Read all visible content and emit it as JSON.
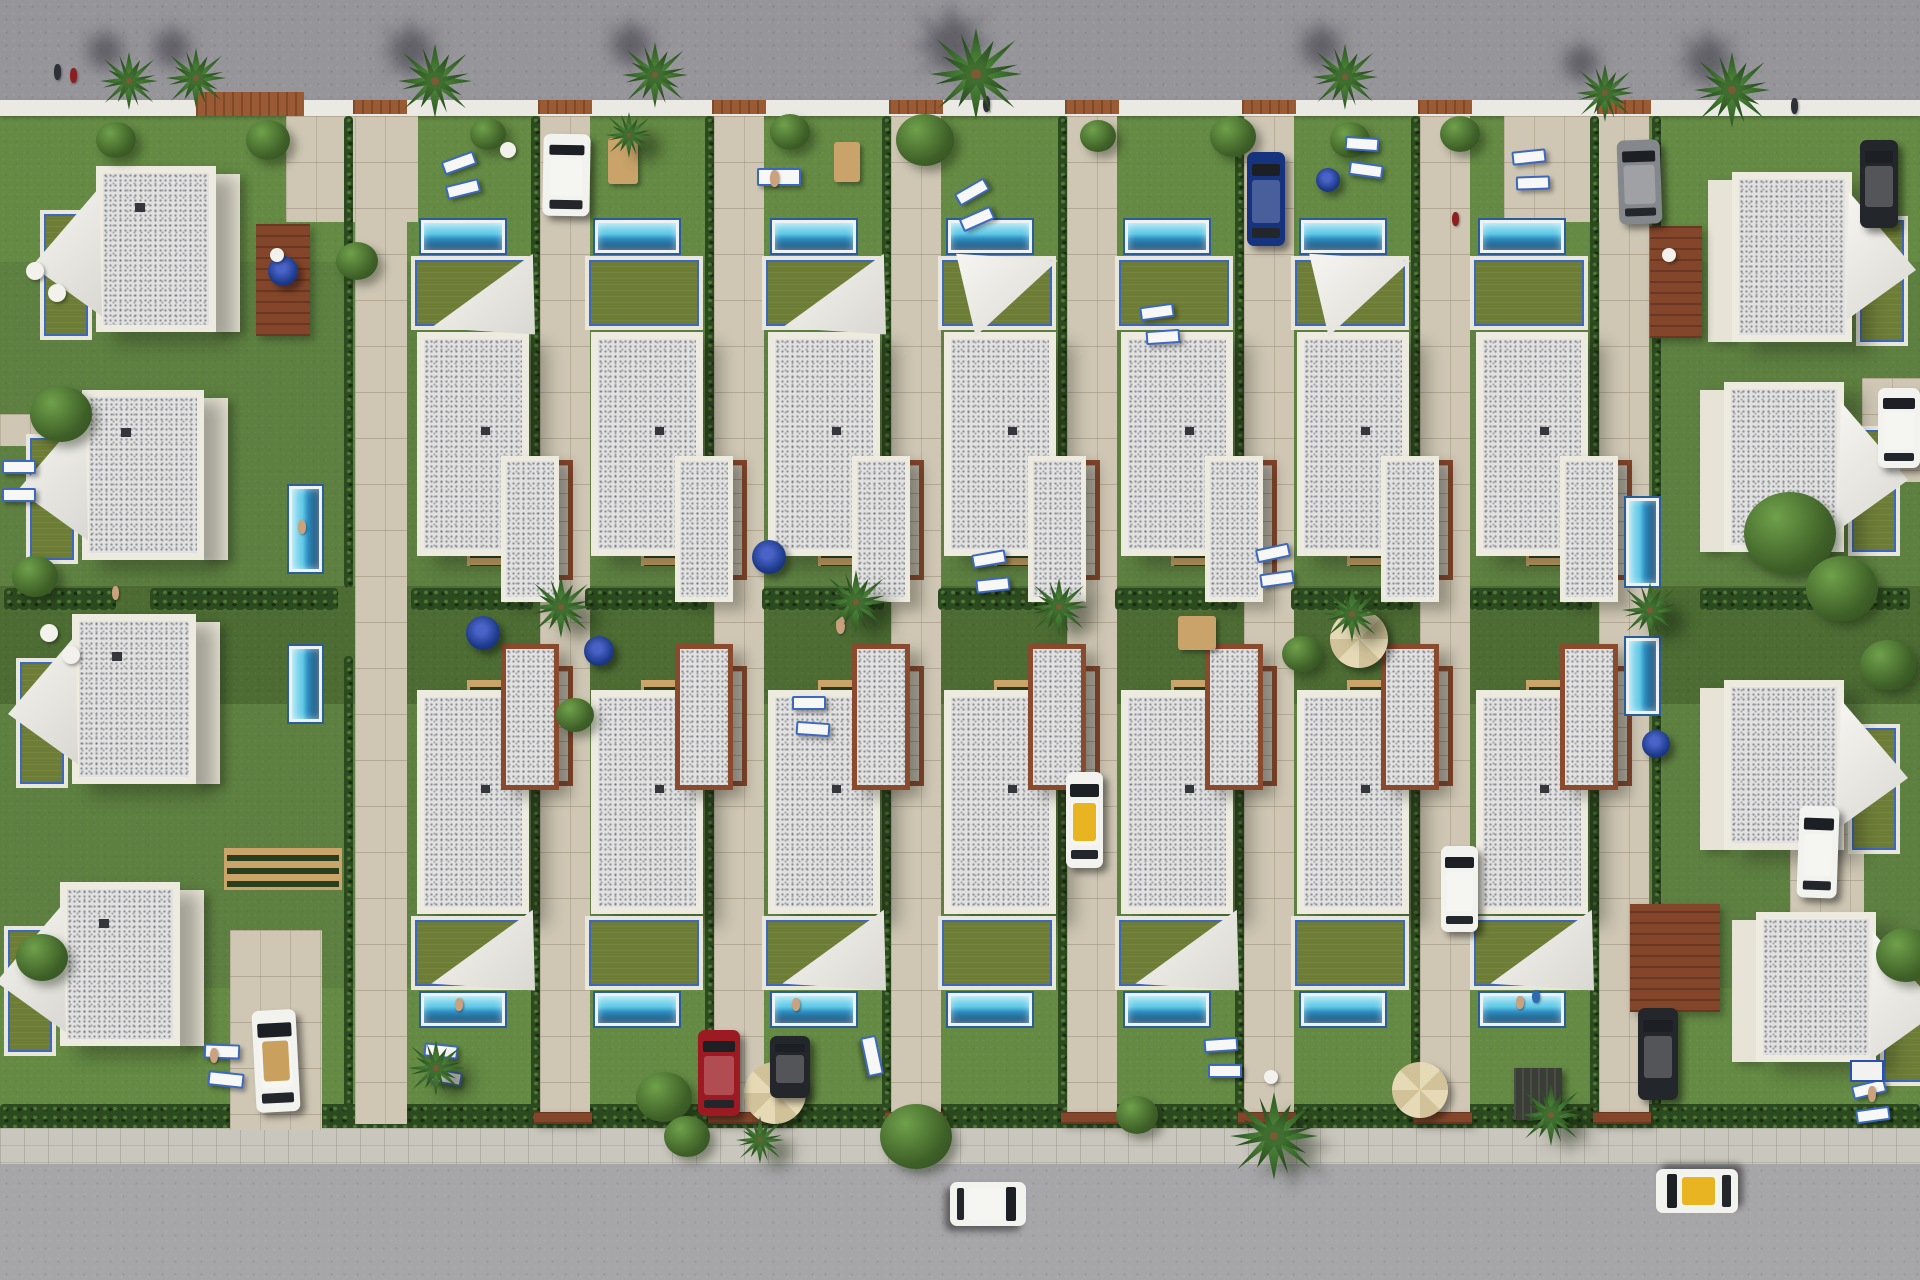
{
  "meta": {
    "description": "Aerial top-down 3D render of a seaside villa development: two rows of white flat-roof villas with private pools and gardens between two gray roads",
    "width": 1920,
    "height": 1280
  },
  "palette": {
    "road_top": "#96959a",
    "road_bottom": "#a6a5a8",
    "curb_white": "#eae9e3",
    "curb_cobble": "#c9c6bd",
    "lawn": "#5d8041",
    "lawn_light": "#648a44",
    "lawn_dark": "#4c6c33",
    "hedge": "#2c4a1f",
    "pavement": "#cfc7b4",
    "roof_speckle": "#e1e1e1",
    "parapet": "#edebe0",
    "wall_cream": "#e7e3d6",
    "terrace_turf": "#6d7d36",
    "balustrade_blue": "#3c68c0",
    "pool_light": "#a8e4f4",
    "pool_deep": "#16436b",
    "pool_trim": "#2a5d9c",
    "wood_deck": "#84462b",
    "wood_stairs": "#caa468",
    "sail_white": "#f7f6f2",
    "umbrella_navy": "#1e3c8c",
    "umbrella_beige": "#e6d9b5",
    "car_red": "#9c1a22",
    "car_blue": "#16337f",
    "car_gray": "#84878b",
    "car_dark": "#23262b",
    "taxi_yellow": "#e8b421"
  },
  "bands": [
    {
      "cls": "lawn",
      "r": [
        0,
        114,
        1920,
        1012
      ],
      "name": "site-lawn"
    },
    {
      "cls": "lawnL",
      "r": [
        0,
        114,
        1920,
        148
      ],
      "name": "front-gardens-top"
    },
    {
      "cls": "lawnL",
      "r": [
        0,
        988,
        1920,
        142
      ],
      "name": "front-gardens-bottom"
    },
    {
      "cls": "lawnD",
      "r": [
        0,
        586,
        1920,
        118
      ],
      "name": "central-common-lawn"
    },
    {
      "cls": "road",
      "r": [
        0,
        0,
        1920,
        102
      ],
      "name": "top-road"
    },
    {
      "cls": "curb",
      "r": [
        0,
        100,
        1920,
        16
      ],
      "name": "top-perimeter-wall"
    },
    {
      "cls": "hedge",
      "r": [
        0,
        1104,
        1920,
        26
      ],
      "name": "bottom-perimeter-hedge"
    },
    {
      "cls": "curb-b",
      "r": [
        0,
        1128,
        1920,
        38
      ],
      "name": "bottom-sidewalk"
    },
    {
      "cls": "road-b",
      "r": [
        0,
        1164,
        1920,
        116
      ],
      "name": "bottom-road"
    }
  ],
  "units": {
    "xs": [
      409,
      583,
      760,
      936,
      1113,
      1289,
      1468
    ],
    "mirror_axis": 1246,
    "top": {
      "pool": [
        12,
        220,
        84,
        33
      ],
      "terrace": [
        2,
        256,
        118,
        74
      ],
      "roof": [
        8,
        332,
        112,
        224
      ],
      "wing": [
        92,
        456,
        58,
        146
      ],
      "slab": [
        118,
        460,
        46,
        120
      ],
      "stairs": [
        58,
        480,
        50,
        86
      ]
    },
    "top_sails": [
      0,
      2,
      3,
      5
    ],
    "bottom_sails": [
      0,
      2,
      4,
      6
    ],
    "driveway_offset": 131,
    "driveway_width": 50,
    "driveway_y": 116,
    "driveway_h": 1008
  },
  "extra_paves": [
    [
      286,
      116,
      132,
      106
    ],
    [
      1504,
      116,
      136,
      106
    ],
    [
      230,
      930,
      92,
      200
    ],
    [
      355,
      116,
      52,
      1008
    ],
    [
      1790,
      788,
      74,
      124
    ],
    [
      1862,
      378,
      58,
      104
    ],
    [
      0,
      414,
      58,
      32
    ],
    [
      1862,
      414,
      58,
      32
    ]
  ],
  "extra_hedges_v": [
    [
      344,
      116,
      9,
      472
    ],
    [
      344,
      656,
      9,
      452
    ],
    [
      1652,
      116,
      9,
      472
    ],
    [
      1652,
      656,
      9,
      452
    ]
  ],
  "hedgerow_extra": [
    [
      4,
      588,
      112,
      22
    ],
    [
      150,
      588,
      188,
      22
    ],
    [
      1700,
      588,
      210,
      22
    ]
  ],
  "corner_villas": {
    "left": [
      [
        96,
        166,
        120,
        166
      ],
      [
        82,
        390,
        122,
        170
      ],
      [
        72,
        614,
        124,
        170
      ],
      [
        60,
        882,
        120,
        164
      ]
    ],
    "right": [
      [
        1732,
        172,
        120,
        170
      ],
      [
        1724,
        382,
        120,
        170
      ],
      [
        1724,
        680,
        120,
        170
      ],
      [
        1756,
        912,
        120,
        150
      ]
    ]
  },
  "vertical_pools": [
    [
      289,
      486,
      33,
      86
    ],
    [
      289,
      646,
      33,
      76
    ],
    [
      1626,
      498,
      33,
      88
    ],
    [
      1626,
      638,
      33,
      76
    ]
  ],
  "decks": [
    {
      "cls": "deck",
      "r": [
        256,
        224,
        54,
        112
      ]
    },
    {
      "cls": "deck",
      "r": [
        1650,
        226,
        52,
        112
      ]
    },
    {
      "cls": "deck",
      "r": [
        1630,
        904,
        90,
        108
      ]
    },
    {
      "cls": "stairs",
      "r": [
        224,
        848,
        118,
        42
      ]
    },
    {
      "cls": "deck-top",
      "r": [
        196,
        92,
        108,
        24
      ]
    }
  ],
  "palms": [
    [
      100,
      52,
      58,
      "ul"
    ],
    [
      166,
      48,
      60,
      "ul"
    ],
    [
      398,
      44,
      74,
      "ul"
    ],
    [
      622,
      42,
      66,
      "ul"
    ],
    [
      930,
      28,
      92,
      "ul"
    ],
    [
      1312,
      44,
      66,
      "ul"
    ],
    [
      1576,
      64,
      58,
      "ul"
    ],
    [
      1694,
      52,
      76,
      "ul"
    ],
    [
      606,
      112,
      46,
      "dr"
    ],
    [
      530,
      576,
      62,
      "dr"
    ],
    [
      824,
      570,
      64,
      "dr"
    ],
    [
      1030,
      578,
      58,
      "dr"
    ],
    [
      1324,
      586,
      56,
      "dr"
    ],
    [
      1622,
      582,
      56,
      "dr"
    ],
    [
      408,
      1040,
      56,
      "dr"
    ],
    [
      1230,
      1092,
      88,
      "dr"
    ],
    [
      1520,
      1084,
      62,
      "dr"
    ],
    [
      736,
      1116,
      48,
      "dr"
    ]
  ],
  "bushes": [
    [
      96,
      122,
      40
    ],
    [
      246,
      120,
      44
    ],
    [
      470,
      118,
      36
    ],
    [
      770,
      114,
      40
    ],
    [
      896,
      114,
      58
    ],
    [
      1080,
      120,
      36
    ],
    [
      1210,
      116,
      46
    ],
    [
      1330,
      122,
      40
    ],
    [
      1440,
      116,
      40
    ],
    [
      30,
      386,
      62
    ],
    [
      12,
      556,
      46
    ],
    [
      336,
      242,
      42
    ],
    [
      1744,
      492,
      92
    ],
    [
      1806,
      556,
      72
    ],
    [
      1860,
      640,
      56
    ],
    [
      556,
      698,
      38
    ],
    [
      1282,
      636,
      40
    ],
    [
      636,
      1072,
      56
    ],
    [
      880,
      1104,
      72
    ],
    [
      664,
      1116,
      46
    ],
    [
      1116,
      1096,
      42
    ],
    [
      16,
      934,
      52
    ],
    [
      1876,
      928,
      60
    ]
  ],
  "cars": [
    {
      "v": "white",
      "x": 543,
      "y": 134,
      "w": 47,
      "h": 82,
      "r": 1
    },
    {
      "v": "blue",
      "x": 1247,
      "y": 152,
      "w": 38,
      "h": 94,
      "r": 0
    },
    {
      "v": "gray",
      "x": 1618,
      "y": 140,
      "w": 43,
      "h": 84,
      "r": -2
    },
    {
      "v": "dark",
      "x": 1860,
      "y": 140,
      "w": 38,
      "h": 88,
      "r": 0
    },
    {
      "v": "white",
      "x": 1878,
      "y": 388,
      "w": 42,
      "h": 80,
      "r": 0
    },
    {
      "v": "taxi",
      "x": 1066,
      "y": 772,
      "w": 37,
      "h": 96,
      "r": 0
    },
    {
      "v": "white",
      "x": 1441,
      "y": 846,
      "w": 37,
      "h": 86,
      "r": 0
    },
    {
      "v": "white",
      "x": 1798,
      "y": 806,
      "w": 40,
      "h": 92,
      "r": 2
    },
    {
      "v": "conv",
      "x": 254,
      "y": 1010,
      "w": 44,
      "h": 102,
      "r": -3
    },
    {
      "v": "red",
      "x": 698,
      "y": 1030,
      "w": 42,
      "h": 86,
      "r": 0
    },
    {
      "v": "dark",
      "x": 770,
      "y": 1036,
      "w": 40,
      "h": 62,
      "r": 0
    },
    {
      "v": "dark",
      "x": 1638,
      "y": 1008,
      "w": 40,
      "h": 92,
      "r": 0
    },
    {
      "v": "white",
      "x": 966,
      "y": 1166,
      "w": 44,
      "h": 76,
      "r": 90
    },
    {
      "v": "taxi",
      "x": 1675,
      "y": 1150,
      "w": 44,
      "h": 82,
      "r": -90
    }
  ],
  "props": [
    {
      "t": "umb-n",
      "r": [
        752,
        540,
        34,
        34
      ]
    },
    {
      "t": "umb-n",
      "r": [
        466,
        616,
        34,
        34
      ]
    },
    {
      "t": "umb-n",
      "r": [
        584,
        636,
        30,
        30
      ]
    },
    {
      "t": "umb-n",
      "r": [
        1316,
        168,
        24,
        24
      ]
    },
    {
      "t": "umb-n",
      "r": [
        1536,
        1096,
        22,
        22
      ]
    },
    {
      "t": "umb-n",
      "r": [
        1642,
        730,
        28,
        28
      ]
    },
    {
      "t": "umb-n",
      "r": [
        268,
        256,
        30,
        30
      ]
    },
    {
      "t": "umb-b",
      "r": [
        744,
        1062,
        62,
        62
      ]
    },
    {
      "t": "umb-b",
      "r": [
        1392,
        1062,
        56,
        56
      ]
    },
    {
      "t": "umb-b",
      "r": [
        1330,
        610,
        58,
        58
      ]
    },
    {
      "t": "table",
      "r": [
        608,
        138,
        30,
        46
      ]
    },
    {
      "t": "table",
      "r": [
        834,
        142,
        26,
        40
      ]
    },
    {
      "t": "table",
      "r": [
        1178,
        616,
        38,
        34
      ]
    },
    {
      "t": "lounger",
      "r": [
        442,
        156,
        34,
        14
      ],
      "rot": -20
    },
    {
      "t": "lounger",
      "r": [
        446,
        182,
        34,
        14
      ],
      "rot": -14
    },
    {
      "t": "lounger",
      "r": [
        955,
        185,
        34,
        14
      ],
      "rot": -30
    },
    {
      "t": "lounger",
      "r": [
        960,
        212,
        34,
        14
      ],
      "rot": -24
    },
    {
      "t": "lounger",
      "r": [
        1512,
        150,
        34,
        14
      ],
      "rot": -6
    },
    {
      "t": "lounger",
      "r": [
        1516,
        176,
        34,
        14
      ],
      "rot": -2
    },
    {
      "t": "lounger",
      "r": [
        1345,
        137,
        34,
        14
      ],
      "rot": 4
    },
    {
      "t": "lounger",
      "r": [
        1349,
        163,
        34,
        14
      ],
      "rot": 8
    },
    {
      "t": "lounger",
      "r": [
        757,
        168,
        44,
        18
      ],
      "rot": 0
    },
    {
      "t": "lounger",
      "r": [
        1140,
        305,
        34,
        14
      ],
      "rot": -8
    },
    {
      "t": "lounger",
      "r": [
        1146,
        330,
        34,
        14
      ],
      "rot": -4
    },
    {
      "t": "lounger",
      "r": [
        2,
        460,
        34,
        14
      ],
      "rot": 0
    },
    {
      "t": "lounger",
      "r": [
        2,
        488,
        34,
        14
      ],
      "rot": 0
    },
    {
      "t": "lounger",
      "r": [
        972,
        552,
        34,
        14
      ],
      "rot": -10
    },
    {
      "t": "lounger",
      "r": [
        976,
        578,
        34,
        14
      ],
      "rot": -6
    },
    {
      "t": "lounger",
      "r": [
        1256,
        546,
        34,
        14
      ],
      "rot": -12
    },
    {
      "t": "lounger",
      "r": [
        1260,
        572,
        34,
        14
      ],
      "rot": -8
    },
    {
      "t": "lounger",
      "r": [
        792,
        696,
        34,
        14
      ],
      "rot": 0
    },
    {
      "t": "lounger",
      "r": [
        796,
        722,
        34,
        14
      ],
      "rot": 4
    },
    {
      "t": "lounger",
      "r": [
        424,
        1044,
        34,
        14
      ],
      "rot": 6
    },
    {
      "t": "lounger",
      "r": [
        428,
        1070,
        34,
        14
      ],
      "rot": 10
    },
    {
      "t": "lounger",
      "r": [
        852,
        1048,
        40,
        16
      ],
      "rot": 78
    },
    {
      "t": "lounger",
      "r": [
        1204,
        1038,
        34,
        14
      ],
      "rot": -4
    },
    {
      "t": "lounger",
      "r": [
        1208,
        1064,
        34,
        14
      ],
      "rot": 0
    },
    {
      "t": "lounger",
      "r": [
        1852,
        1082,
        34,
        14
      ],
      "rot": -14
    },
    {
      "t": "lounger",
      "r": [
        1856,
        1108,
        34,
        14
      ],
      "rot": -8
    },
    {
      "t": "lounger",
      "r": [
        204,
        1044,
        36,
        15
      ],
      "rot": 2
    },
    {
      "t": "lounger",
      "r": [
        208,
        1072,
        36,
        15
      ],
      "rot": 6
    },
    {
      "t": "chair",
      "r": [
        500,
        142,
        16,
        16
      ]
    },
    {
      "t": "chair",
      "r": [
        26,
        262,
        18,
        18
      ]
    },
    {
      "t": "chair",
      "r": [
        48,
        284,
        18,
        18
      ]
    },
    {
      "t": "chair",
      "r": [
        270,
        248,
        14,
        14
      ]
    },
    {
      "t": "chair",
      "r": [
        1662,
        248,
        14,
        14
      ]
    },
    {
      "t": "chair",
      "r": [
        40,
        624,
        18,
        18
      ]
    },
    {
      "t": "chair",
      "r": [
        62,
        646,
        18,
        18
      ]
    },
    {
      "t": "chair",
      "r": [
        1264,
        1070,
        14,
        14
      ]
    },
    {
      "t": "cool",
      "r": [
        1850,
        1060,
        34,
        22
      ]
    },
    {
      "t": "perg",
      "r": [
        1514,
        1068,
        48,
        52
      ]
    },
    {
      "t": "person",
      "r": [
        54,
        64,
        7,
        16
      ],
      "c": "#2e3038"
    },
    {
      "t": "person",
      "r": [
        70,
        68,
        7,
        15
      ],
      "c": "#8c2020"
    },
    {
      "t": "person",
      "r": [
        983,
        96,
        7,
        16
      ],
      "c": "#2e3038"
    },
    {
      "t": "person",
      "r": [
        1791,
        98,
        7,
        16
      ],
      "c": "#2e3038"
    },
    {
      "t": "person",
      "r": [
        1452,
        212,
        7,
        14
      ],
      "c": "#8c2020"
    },
    {
      "t": "person",
      "r": [
        770,
        170,
        9,
        17
      ],
      "c": "#caa27e"
    },
    {
      "t": "person",
      "r": [
        298,
        520,
        8,
        14
      ],
      "c": "#caa27e"
    },
    {
      "t": "person",
      "r": [
        836,
        616,
        9,
        18
      ],
      "c": "#caa27e"
    },
    {
      "t": "person",
      "r": [
        455,
        998,
        8,
        13
      ],
      "c": "#caa27e"
    },
    {
      "t": "person",
      "r": [
        792,
        998,
        8,
        13
      ],
      "c": "#caa27e"
    },
    {
      "t": "person",
      "r": [
        1516,
        996,
        8,
        13
      ],
      "c": "#caa27e"
    },
    {
      "t": "person",
      "r": [
        1532,
        990,
        8,
        13
      ],
      "c": "#2e6ab0"
    },
    {
      "t": "person",
      "r": [
        1868,
        1086,
        8,
        16
      ],
      "c": "#caa27e"
    },
    {
      "t": "person",
      "r": [
        112,
        586,
        7,
        14
      ],
      "c": "#caa27e"
    },
    {
      "t": "person",
      "r": [
        210,
        1048,
        8,
        15
      ],
      "c": "#caa27e"
    }
  ]
}
